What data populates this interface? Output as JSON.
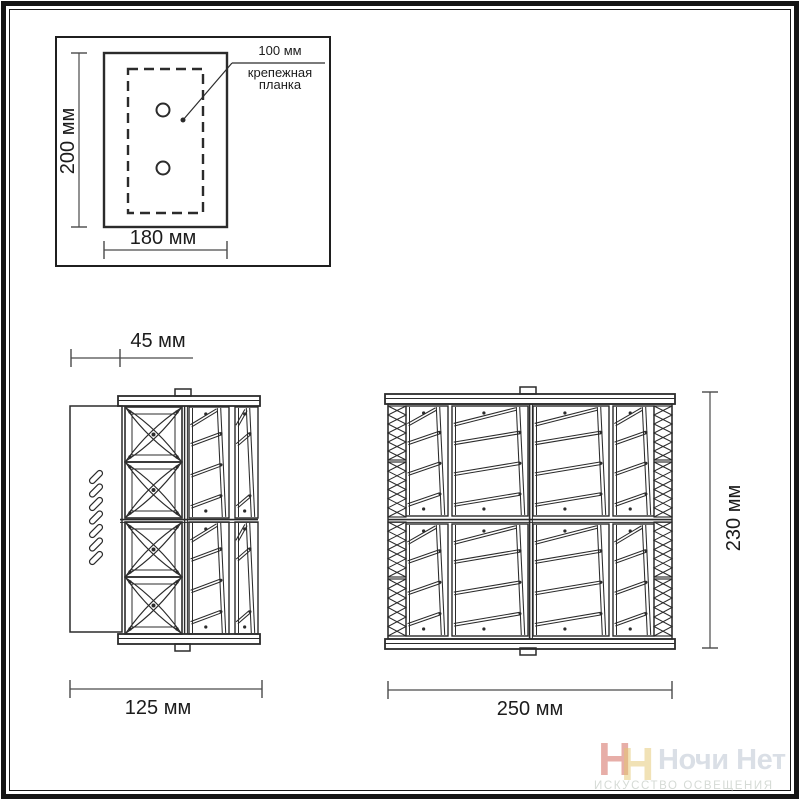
{
  "mounting_diagram": {
    "height_label": "200 мм",
    "width_label": "180 мм",
    "offset_label": "100 мм",
    "bracket_label": "крепежная планка"
  },
  "side_view": {
    "depth_label": "45 мм",
    "width_label": "125 мм"
  },
  "front_view": {
    "width_label": "250 мм",
    "height_label": "230 мм"
  },
  "watermark": {
    "icon_letters": [
      "Н",
      "Н"
    ],
    "brand": "Ночи Нет",
    "tagline": "ИСКУССТВО ОСВЕЩЕНИЯ",
    "icon_red": "#c63e30",
    "icon_cream": "#e4c66e",
    "text_color": "#bcc4d2"
  }
}
